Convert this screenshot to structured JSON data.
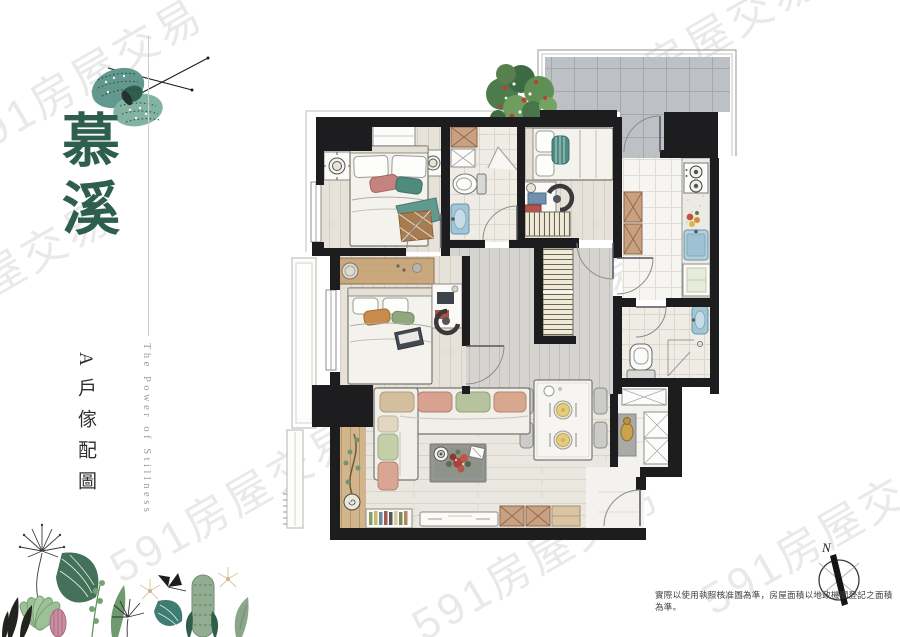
{
  "brand": {
    "title": "慕溪",
    "unit_label": "A戶傢配圖",
    "tagline": "The Power of Stillness",
    "accent_color": "#2e5e4d"
  },
  "watermark": {
    "text": "591房屋交易",
    "color": "#dcdcdc"
  },
  "compass": {
    "north_label": "N"
  },
  "footer": {
    "disclaimer": "實際以使用執照核准圖為準，房屋面積以地政機關登記之面積為準。"
  },
  "colors": {
    "wall": "#1d1d1f",
    "terrace_tile": "#bdc0c4",
    "wood_floor": "#e7e2d9",
    "hall_floor": "#d6d4d0",
    "fixture_blue": "#a3c6d6",
    "wood_furniture": "#c9a87d"
  }
}
